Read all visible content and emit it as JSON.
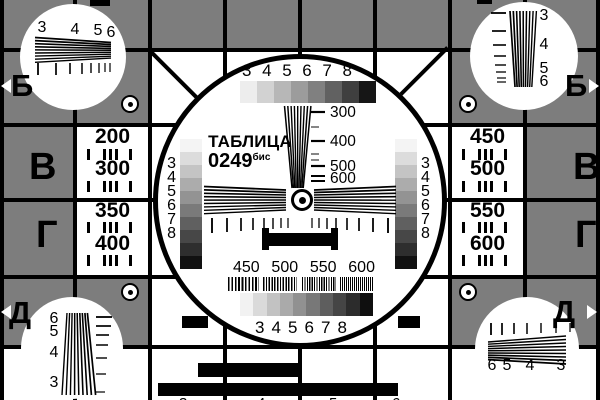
{
  "colors": {
    "background_gray": "#7d7d7d",
    "line_black": "#000000",
    "cell_white": "#ffffff"
  },
  "title": {
    "name": "ТАБЛИЦА",
    "number": "0249",
    "suffix": "бис"
  },
  "edge_markers": {
    "left": [
      "Б",
      "В",
      "Г",
      "Д"
    ],
    "right": [
      "Б",
      "В",
      "Г",
      "Д"
    ]
  },
  "side_values": {
    "left": [
      "200",
      "300",
      "350",
      "400"
    ],
    "right": [
      "450",
      "500",
      "550",
      "600"
    ]
  },
  "center": {
    "top_scale_labels": [
      "3",
      "4",
      "5",
      "6",
      "7",
      "8"
    ],
    "top_gray_steps": [
      "#ededed",
      "#d2d2d2",
      "#b7b7b7",
      "#9c9c9c",
      "#808080",
      "#616161",
      "#3f3f3f",
      "#161616"
    ],
    "freq_labels": [
      "300",
      "400",
      "500",
      "600"
    ],
    "side_scale_labels": [
      "3",
      "4",
      "5",
      "6",
      "7",
      "8"
    ],
    "side_gray_steps": [
      "#f4f4f4",
      "#dcdcdc",
      "#c4c4c4",
      "#acacac",
      "#939393",
      "#7a7a7a",
      "#606060",
      "#474747",
      "#2e2e2e",
      "#111111"
    ],
    "bottom_freq_labels": [
      "450",
      "500",
      "550",
      "600"
    ],
    "bottom_gray_steps": [
      "#f2f2f2",
      "#dadada",
      "#c2c2c2",
      "#aaaaaa",
      "#919191",
      "#787878",
      "#5e5e5e",
      "#454545",
      "#2c2c2c",
      "#0f0f0f"
    ],
    "bottom_scale_labels": [
      "3",
      "4",
      "5",
      "6",
      "7",
      "8"
    ]
  },
  "corners": {
    "top_left_labels": [
      "3",
      "4",
      "5",
      "6"
    ],
    "top_right_labels": [
      "3",
      "4",
      "5",
      "6"
    ],
    "bottom_left_labels": [
      "6",
      "5",
      "4",
      "3"
    ],
    "bottom_right_labels": [
      "6",
      "5",
      "4",
      "3"
    ]
  },
  "edge_digits": {
    "top": [
      "3",
      "4",
      "5",
      "6"
    ],
    "bottom": [
      "3",
      "4",
      "5",
      "6"
    ]
  }
}
